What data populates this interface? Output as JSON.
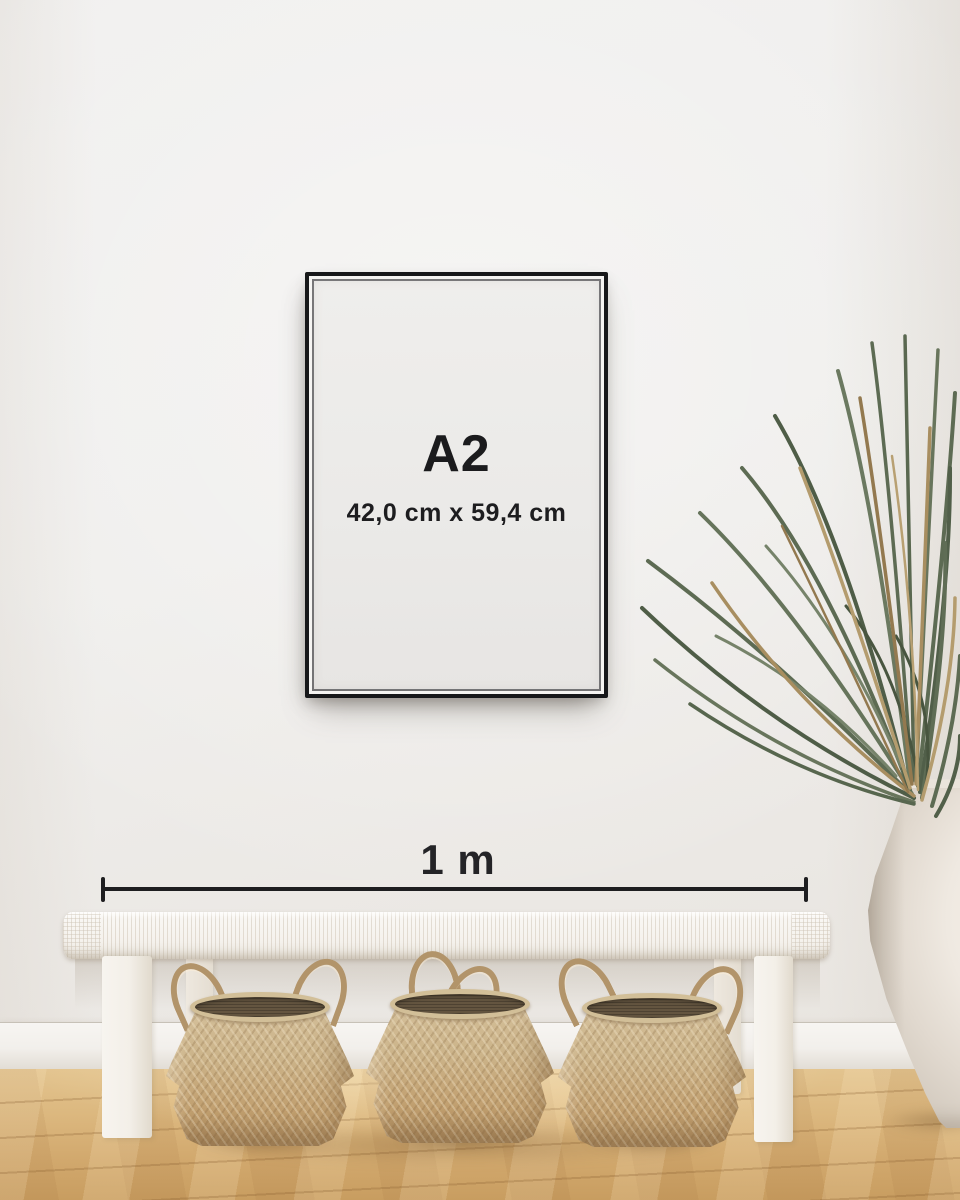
{
  "frame": {
    "size_label": "A2",
    "dimensions_label": "42,0 cm x 59,4 cm",
    "frame_color": "#17181a",
    "paper_color": "#ebeae8",
    "text_color": "#1b1b1d"
  },
  "measure": {
    "label": "1 m",
    "line_color": "#1e1e20"
  },
  "palette": {
    "wall": "#efeeec",
    "baseboard": "#f5f3f0",
    "floor_wood": "#d5ae72",
    "bench": "#f7f5f1",
    "basket_weave": "#c7aa7d",
    "plant_green": "#5d6b53",
    "plant_dry": "#a88e60",
    "vase": "#efe9e1"
  }
}
